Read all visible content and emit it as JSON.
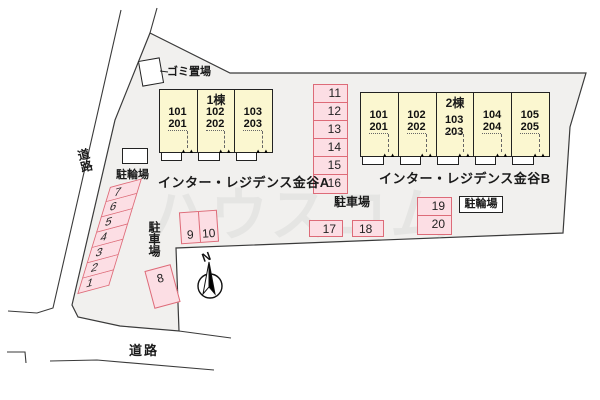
{
  "watermark": "ハウスコム",
  "colors": {
    "site_fill": "#f1f0ee",
    "building_fill": "#fbf7d0",
    "parking_fill": "#fcdee4",
    "parking_border": "#dd6b78"
  },
  "roads": {
    "left": "道路",
    "bottom": "道路"
  },
  "facilities": {
    "garbage": "ゴミ置場",
    "bike_parking_a": "駐輪場",
    "bike_parking_b": "駐輪場",
    "car_parking_left": "駐車場",
    "car_parking_right": "駐車場"
  },
  "compass": {
    "north": "N"
  },
  "building_a": {
    "name": "1棟",
    "label": "インター・レジデンス金谷A",
    "units": [
      {
        "upper": "101",
        "lower": "201"
      },
      {
        "upper": "102",
        "lower": "202"
      },
      {
        "upper": "103",
        "lower": "203"
      }
    ]
  },
  "building_b": {
    "name": "2棟",
    "label": "インター・レジデンス金谷B",
    "units": [
      {
        "upper": "101",
        "lower": "201"
      },
      {
        "upper": "102",
        "lower": "202"
      },
      {
        "upper": "103",
        "lower": "203"
      },
      {
        "upper": "104",
        "lower": "204"
      },
      {
        "upper": "105",
        "lower": "205"
      }
    ]
  },
  "parking": {
    "left_column": [
      "7",
      "6",
      "5",
      "4",
      "3",
      "2",
      "1"
    ],
    "middle_column": [
      "11",
      "12",
      "13",
      "14",
      "15",
      "16"
    ],
    "pair": [
      "9",
      "10"
    ],
    "single": "8",
    "row": [
      "17",
      "18"
    ],
    "stack": [
      "19",
      "20"
    ]
  }
}
